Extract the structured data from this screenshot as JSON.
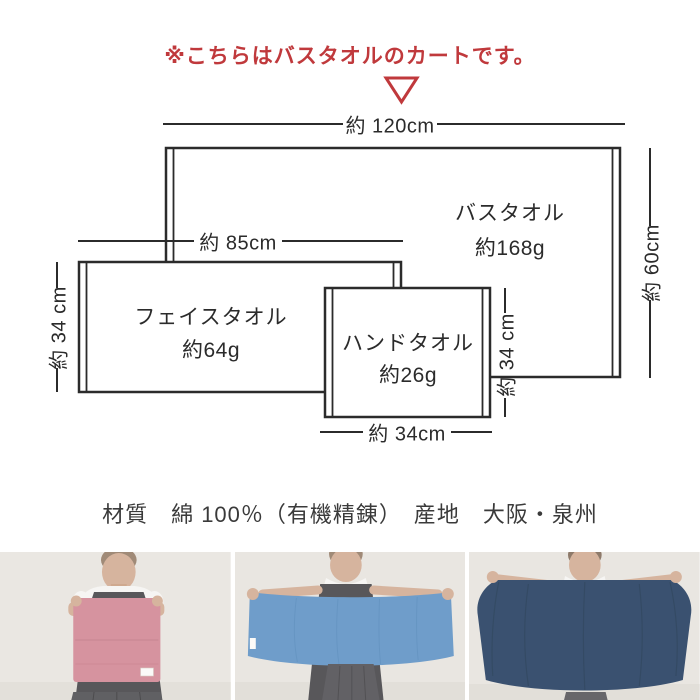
{
  "header": {
    "notice": "※こちらはバスタオルのカートです。"
  },
  "diagram": {
    "bath": {
      "name": "バスタオル",
      "weight": "約168g",
      "width_label": "約 120cm",
      "height_label": "約 60cm"
    },
    "face": {
      "name": "フェイスタオル",
      "weight": "約64g",
      "width_label": "約 85cm",
      "height_label": "約 34 cm"
    },
    "hand": {
      "name": "ハンドタオル",
      "weight": "約26g",
      "width_label": "約 34cm",
      "height_label": "約 34 cm"
    }
  },
  "specs": {
    "material_origin": "材質　綿 100％（有機精錬）　産地　大阪・泉州"
  },
  "colors": {
    "accent_red": "#c0393c",
    "line": "#2b2b2b",
    "hand_towel_pink": "#d6939f",
    "face_towel_blue": "#6f9dca",
    "bath_towel_navy": "#3a5170"
  }
}
